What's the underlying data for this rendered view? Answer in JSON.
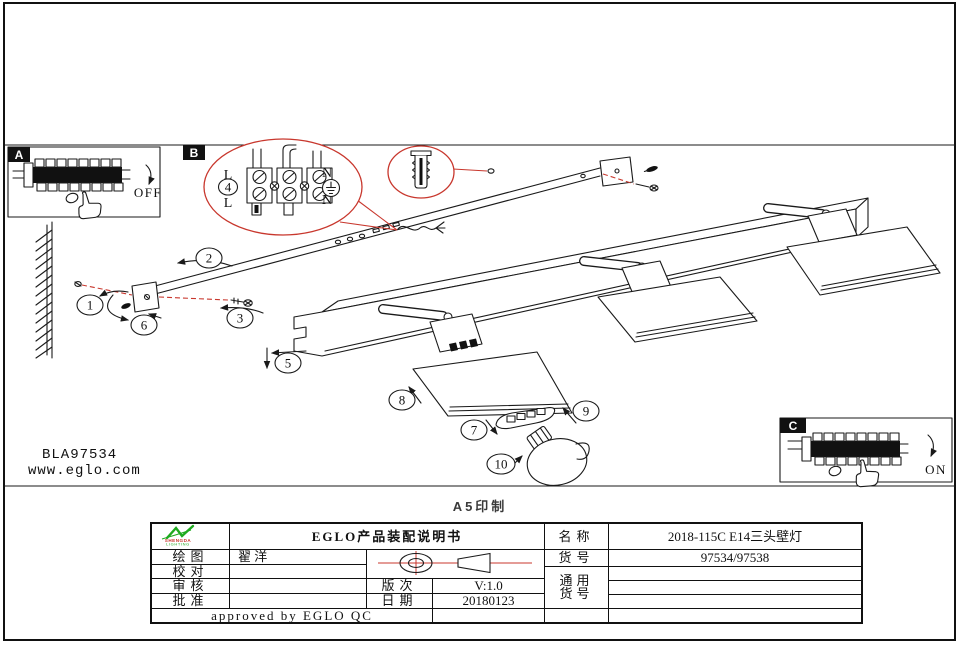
{
  "page": {
    "print_note": "A5印制",
    "product_code": "BLA97534",
    "website": "www.eglo.com"
  },
  "details": {
    "a": {
      "label": "A",
      "state": "OFF"
    },
    "b": {
      "label": "B"
    },
    "c": {
      "label": "C",
      "state": "ON"
    }
  },
  "wiring": {
    "live_top": "L",
    "live_bottom": "L",
    "neutral_top": "N",
    "neutral_bottom": "N"
  },
  "steps": {
    "labels": [
      "1",
      "2",
      "3",
      "4",
      "5",
      "6",
      "7",
      "8",
      "9",
      "10"
    ]
  },
  "icons": {
    "hand": "pointing-hand-icon",
    "wall_anchor": "wall-anchor-icon",
    "terminal_strip": "terminal-strip-icon",
    "earth": "earth-ground-icon",
    "projection": "first-angle-projection-icon",
    "bulb": "light-bulb-icon"
  },
  "title_block": {
    "logo": {
      "line1": "SHENGDA",
      "line2": "LIGHTING"
    },
    "title": "EGLO产品装配说明书",
    "fields": {
      "draw": {
        "label": "绘图",
        "value": "翟 洋"
      },
      "proof": {
        "label": "校对",
        "value": ""
      },
      "review": {
        "label": "审核",
        "value": ""
      },
      "approve": {
        "label": "批准",
        "value": ""
      },
      "version": {
        "label": "版次",
        "value": "V:1.0"
      },
      "date": {
        "label": "日期",
        "value": "20180123"
      },
      "name": {
        "label": "名称",
        "value": "2018-115C E14三头壁灯"
      },
      "item_no": {
        "label": "货号",
        "value": "97534/97538"
      },
      "generic": {
        "label_line1": "通用",
        "label_line2": "货号",
        "value": ""
      },
      "approved_note": "approved by EGLO QC"
    }
  },
  "colors": {
    "line": "#1a1a1a",
    "callout_red": "#c8372d",
    "logo_green": "#1faa1f",
    "label_bg": "#111111"
  }
}
